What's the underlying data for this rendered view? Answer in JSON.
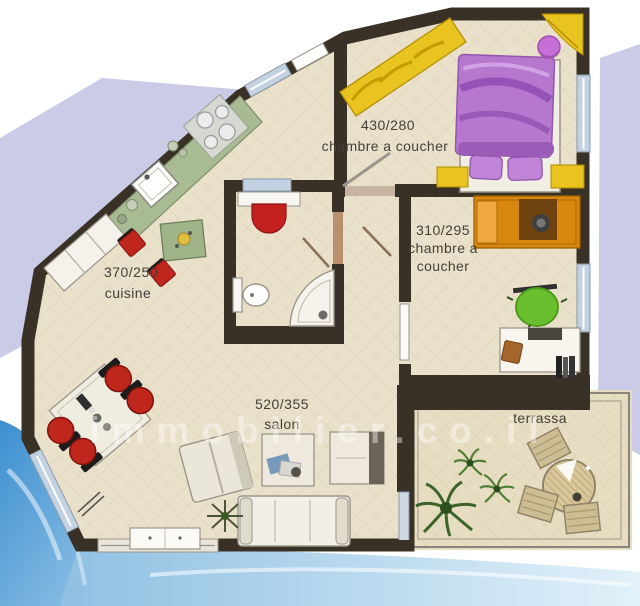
{
  "image_type": "apartment floor plan",
  "watermark": "immobilier.co.il",
  "rooms": {
    "master_bedroom": {
      "dimensions": "430/280",
      "label": "chambre a coucher"
    },
    "second_bedroom": {
      "dimensions": "310/295",
      "label_line1": "chambre a",
      "label_line2": "coucher"
    },
    "kitchen": {
      "dimensions": "370/250",
      "label": "cuisine"
    },
    "salon": {
      "dimensions": "520/355",
      "label": "salon"
    },
    "terrace": {
      "label": "terrassa"
    }
  },
  "colors": {
    "wall": "#3a3126",
    "floor": "#eae1cb",
    "terrace_floor": "#e7ddc2",
    "kitchen_counter_green": "#a9bb92",
    "chair_red": "#bf271d",
    "wardrobe_yellow": "#e9c31f",
    "bed_purple": "#b678cf",
    "bed_orange": "#d8880f",
    "beanbag_green": "#6abf2e",
    "basin_red": "#c32020",
    "window_blue": "#c3d2e2",
    "background_periwinkle": "#c9cbe7",
    "water_blue": "#3c8fd0"
  }
}
